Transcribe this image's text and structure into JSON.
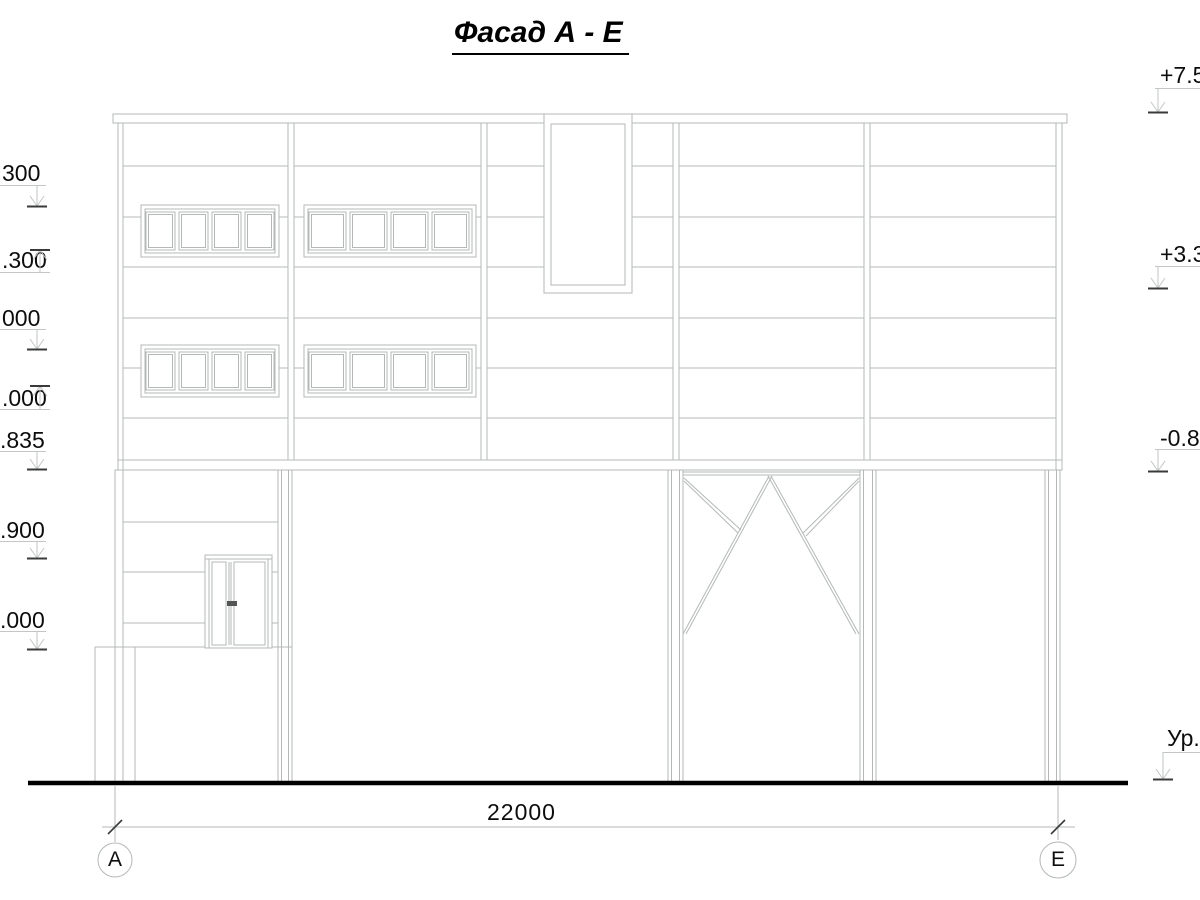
{
  "title": "Фасад А - Е",
  "dimension_label": "22000",
  "grid_bubbles": {
    "left": "А",
    "right": "Е"
  },
  "marks_left": [
    {
      "label": "300"
    },
    {
      "label": ".300"
    },
    {
      "label": "000"
    },
    {
      "label": ".000"
    },
    {
      "label": ".835"
    },
    {
      "label": ".900"
    },
    {
      "label": ".000"
    }
  ],
  "marks_right": [
    {
      "label": "+7.50"
    },
    {
      "label": "+3.30"
    },
    {
      "label": "-0.83"
    },
    {
      "label": "Ур."
    }
  ],
  "colors": {
    "line": "#b4b8b8",
    "text": "#111111",
    "ground": "#000000"
  }
}
